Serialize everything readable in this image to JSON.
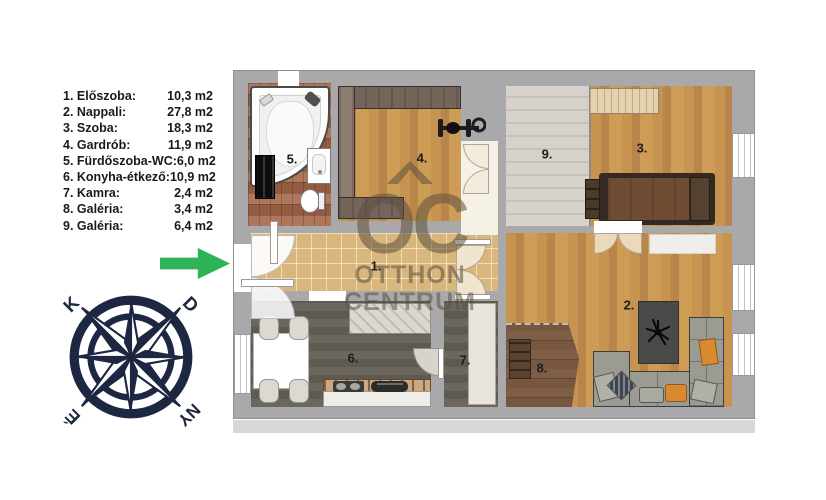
{
  "legend": {
    "items": [
      {
        "name": "1. Előszoba:",
        "area": "10,3 m2"
      },
      {
        "name": "2. Nappali:",
        "area": "27,8 m2"
      },
      {
        "name": "3. Szoba:",
        "area": "18,3 m2"
      },
      {
        "name": "4. Gardrób:",
        "area": "11,9 m2"
      },
      {
        "name": "5. Fürdőszoba-WC:",
        "area": "6,0 m2"
      },
      {
        "name": "6. Konyha-étkező:",
        "area": "10,9 m2"
      },
      {
        "name": "7. Kamra:",
        "area": "2,4 m2"
      },
      {
        "name": "8. Galéria:",
        "area": "3,4 m2"
      },
      {
        "name": "9. Galéria:",
        "area": "6,4 m2"
      }
    ]
  },
  "plan": {
    "room_labels": [
      "1.",
      "2.",
      "3.",
      "4.",
      "5.",
      "6.",
      "7.",
      "8.",
      "9."
    ]
  },
  "compass": {
    "labels": {
      "top_left": "K",
      "top_right": "D",
      "bottom_left": "É",
      "bottom_right": "NY"
    }
  },
  "watermark": {
    "logo": "OC",
    "line1": "OTTHON",
    "line2": "CENTRUM"
  },
  "colors": {
    "wall": "#a9a9ac",
    "wood_floor": "#c2904c",
    "arrow_green": "#2eb457",
    "compass_navy": "#1e2742",
    "accent_orange": "#d98a2e"
  }
}
